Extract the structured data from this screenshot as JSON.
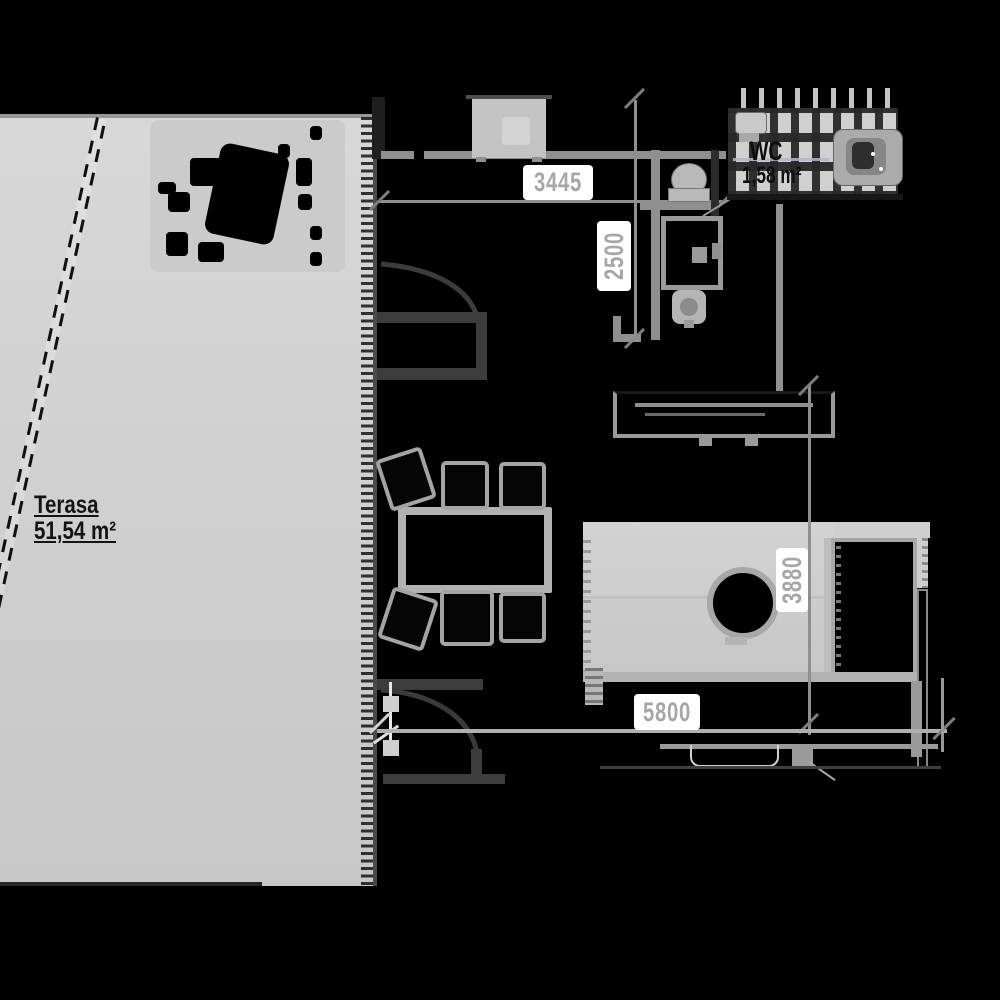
{
  "plan": {
    "title": "Apartment floor plan with terrace",
    "rooms": {
      "terrace": {
        "name": "Terasa",
        "area": "51,54 m²"
      },
      "wc": {
        "name": "WC",
        "area": "1,58 m²"
      }
    },
    "dimensions": {
      "top_width_mm": "3445",
      "wc_depth_mm": "2500",
      "room_depth_mm": "3880",
      "bottom_width_mm": "5800"
    },
    "colors": {
      "background": "#000000",
      "terrace_fill": "#d2d2d2",
      "furniture": "#c9c9c9",
      "wall": "#8f8f8f",
      "dimension_text": "#a6a6a6",
      "label_text": "#141414",
      "accent_line": "#b4b4cf"
    }
  }
}
